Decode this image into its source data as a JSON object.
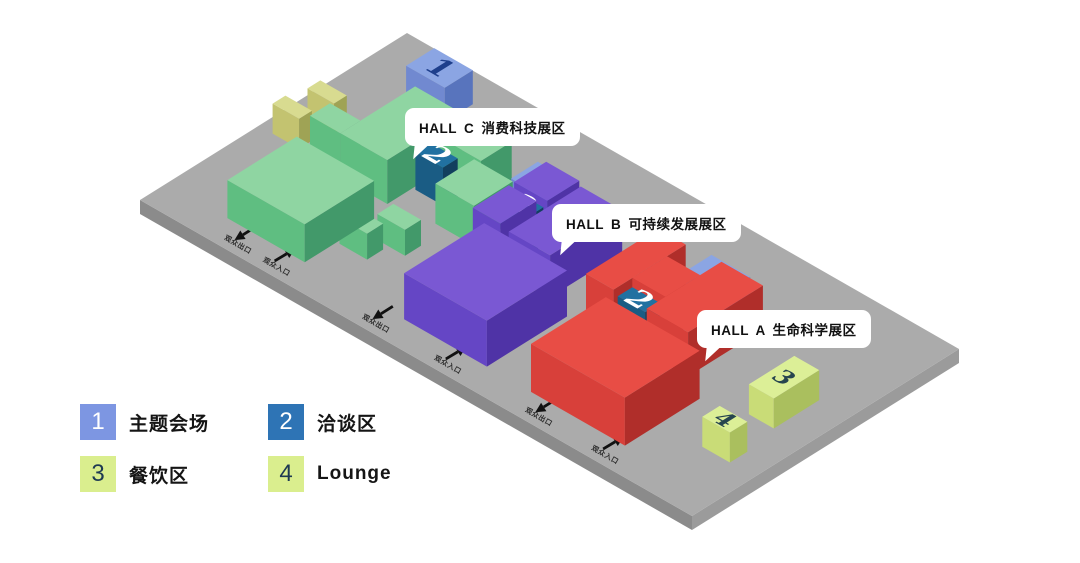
{
  "scene": {
    "canvas": {
      "w": 1080,
      "h": 563,
      "bg": "#ffffff"
    },
    "platform": {
      "origin": [
        140,
        200
      ],
      "axisA": [
        267,
        -167
      ],
      "axisB": [
        552,
        316
      ],
      "thickness": 14,
      "colors": {
        "top": "#ababab",
        "sw": "#8b8b8b",
        "se": "#9b9b9b"
      }
    },
    "palette": {
      "green": {
        "top": "#8fd5a2",
        "sw": "#5fbe81",
        "se": "#42996a"
      },
      "purple": {
        "top": "#7a58d3",
        "sw": "#6546c5",
        "se": "#4f33a6"
      },
      "red": {
        "top": "#e84d45",
        "sw": "#d8403a",
        "se": "#b02e2a"
      },
      "blue": {
        "top": "#8ba5e3",
        "sw": "#7189d0",
        "se": "#5874bd",
        "num": "#1e3f8c",
        "numSize": 30
      },
      "teal": {
        "top": "#2171a1",
        "sw": "#1a5c84",
        "se": "#123f5e",
        "num": "#ffffff",
        "numSize": 30
      },
      "yellow": {
        "top": "#d8db90",
        "sw": "#c3c370",
        "se": "#9fa355"
      },
      "lime": {
        "top": "#dcef97",
        "sw": "#c9dc77",
        "se": "#aabf5e",
        "num": "#27454f",
        "numSize": 24
      }
    },
    "structures": [
      {
        "name": "stage-block-hall-c",
        "set": "blue",
        "num": "1",
        "a": 0.79,
        "b": 0.1,
        "da": 0.105,
        "db": 0.07,
        "h": 34
      },
      {
        "name": "lounge-cube-a",
        "set": "yellow",
        "a": 0.555,
        "b": 0.035,
        "da": 0.048,
        "db": 0.048,
        "h": 30
      },
      {
        "name": "lounge-cube-b",
        "set": "yellow",
        "a": 0.445,
        "b": 0.025,
        "da": 0.048,
        "db": 0.048,
        "h": 30
      },
      {
        "name": "hall-c-step",
        "set": "green",
        "a": 0.43,
        "b": 0.1,
        "da": 0.075,
        "db": 0.055,
        "h": 44
      },
      {
        "name": "hall-c-back",
        "set": "green",
        "a": 0.43,
        "b": 0.155,
        "da": 0.28,
        "db": 0.085,
        "h": 44
      },
      {
        "name": "hall-c-back-right",
        "set": "green",
        "a": 0.595,
        "b": 0.24,
        "da": 0.115,
        "db": 0.09,
        "h": 44
      },
      {
        "name": "meeting-block-hall-c",
        "set": "teal",
        "num": "2",
        "a": 0.525,
        "b": 0.245,
        "da": 0.055,
        "db": 0.05,
        "h": 38
      },
      {
        "name": "hall-c-front",
        "set": "green",
        "a": 0.1,
        "b": 0.11,
        "da": 0.26,
        "db": 0.14,
        "h": 38
      },
      {
        "name": "hall-c-cube-a",
        "set": "green",
        "a": 0.22,
        "b": 0.255,
        "da": 0.06,
        "db": 0.05,
        "h": 26
      },
      {
        "name": "hall-c-cube-b",
        "set": "green",
        "a": 0.3,
        "b": 0.285,
        "da": 0.06,
        "db": 0.05,
        "h": 26
      },
      {
        "name": "hall-c-mid",
        "set": "green",
        "a": 0.455,
        "b": 0.315,
        "da": 0.145,
        "db": 0.07,
        "h": 40
      },
      {
        "name": "stage-block-hall-b",
        "set": "blue",
        "num": "1",
        "a": 0.625,
        "b": 0.37,
        "da": 0.1,
        "db": 0.065,
        "h": 34
      },
      {
        "name": "hall-b-back",
        "set": "purple",
        "a": 0.44,
        "b": 0.39,
        "da": 0.135,
        "db": 0.05,
        "h": 42
      },
      {
        "name": "meeting-block-hall-b",
        "set": "teal",
        "num": "2",
        "a": 0.525,
        "b": 0.4,
        "da": 0.055,
        "db": 0.05,
        "h": 38
      },
      {
        "name": "hall-b-back-right",
        "set": "purple",
        "a": 0.595,
        "b": 0.39,
        "da": 0.12,
        "db": 0.06,
        "h": 42
      },
      {
        "name": "hall-b-back-front",
        "set": "purple",
        "a": 0.43,
        "b": 0.46,
        "da": 0.27,
        "db": 0.075,
        "h": 42
      },
      {
        "name": "hall-b-main",
        "set": "purple",
        "a": 0.1,
        "b": 0.43,
        "da": 0.3,
        "db": 0.15,
        "h": 46
      },
      {
        "name": "stage-block-hall-a",
        "set": "blue",
        "num": "1",
        "a": 0.645,
        "b": 0.675,
        "da": 0.1,
        "db": 0.07,
        "h": 34
      },
      {
        "name": "hall-a-back",
        "set": "red",
        "a": 0.43,
        "b": 0.6,
        "da": 0.27,
        "db": 0.05,
        "h": 44
      },
      {
        "name": "meeting-block-hall-a",
        "set": "teal",
        "num": "2",
        "a": 0.435,
        "b": 0.655,
        "da": 0.055,
        "db": 0.05,
        "h": 38
      },
      {
        "name": "hall-a-back-right",
        "set": "red",
        "a": 0.5,
        "b": 0.65,
        "da": 0.13,
        "db": 0.06,
        "h": 44
      },
      {
        "name": "hall-a-back-front",
        "set": "red",
        "a": 0.43,
        "b": 0.71,
        "da": 0.28,
        "db": 0.075,
        "h": 44
      },
      {
        "name": "hall-a-main",
        "set": "red",
        "a": 0.1,
        "b": 0.66,
        "da": 0.28,
        "db": 0.17,
        "h": 48
      },
      {
        "name": "dining-block",
        "set": "lime",
        "num": "3",
        "a": 0.42,
        "b": 0.9,
        "da": 0.17,
        "db": 0.045,
        "h": 30
      },
      {
        "name": "lounge-block",
        "set": "lime",
        "num": "4",
        "a": 0.235,
        "b": 0.905,
        "da": 0.065,
        "db": 0.05,
        "h": 30
      }
    ],
    "gates": [
      {
        "label": "观众出口",
        "dir": "out",
        "b": 0.15
      },
      {
        "label": "观众入口",
        "dir": "in",
        "b": 0.22
      },
      {
        "label": "观众出口",
        "dir": "out",
        "b": 0.4
      },
      {
        "label": "观众入口",
        "dir": "in",
        "b": 0.53
      },
      {
        "label": "观众出口",
        "dir": "out",
        "b": 0.695
      },
      {
        "label": "观众入口",
        "dir": "in",
        "b": 0.815
      }
    ]
  },
  "halls": [
    {
      "text": "HALL C 消费科技展区",
      "x": 405,
      "y": 108
    },
    {
      "text": "HALL B 可持续发展展区",
      "x": 552,
      "y": 204
    },
    {
      "text": "HALL A 生命科学展区",
      "x": 697,
      "y": 310
    }
  ],
  "legend": {
    "items": [
      {
        "num": "1",
        "label": "主题会场",
        "color": "#7d96e2",
        "numColor": "#ffffff"
      },
      {
        "num": "2",
        "label": "洽谈区",
        "color": "#2e74b5",
        "numColor": "#ffffff"
      },
      {
        "num": "3",
        "label": "餐饮区",
        "color": "#daee8e",
        "numColor": "#1e3a52"
      },
      {
        "num": "4",
        "label": "Lounge",
        "color": "#daee8e",
        "numColor": "#1e3a52"
      }
    ]
  }
}
